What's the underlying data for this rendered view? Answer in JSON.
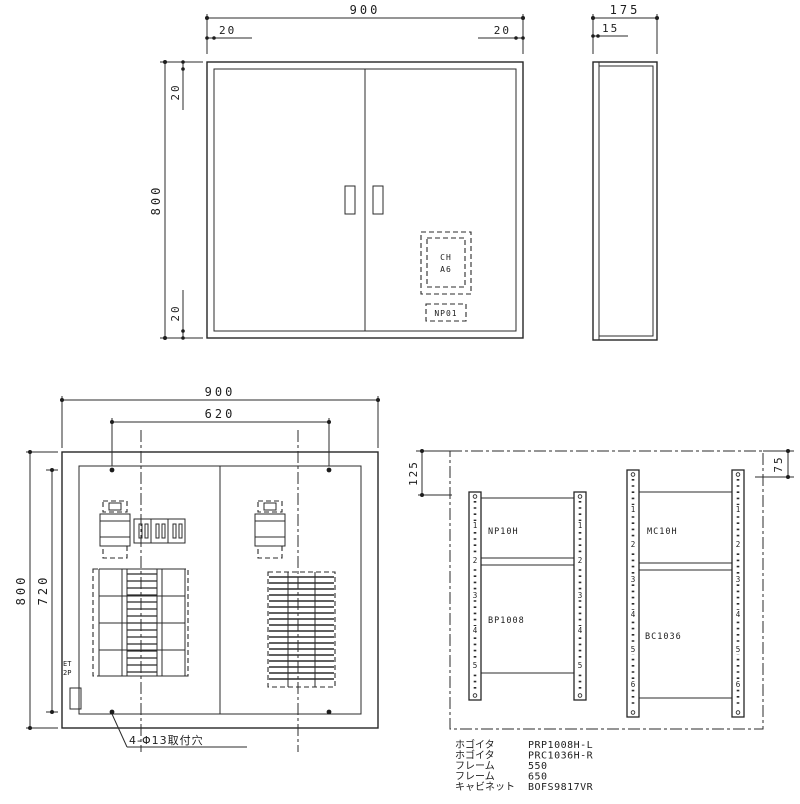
{
  "drawing": {
    "front_view": {
      "dim_width": "900",
      "dim_margin_left": "20",
      "dim_margin_right": "20",
      "dim_height": "800",
      "dim_margin_top": "20",
      "dim_margin_bottom": "20",
      "cutout_line1": "CH",
      "cutout_line2": "A6",
      "nameplate": "NP01"
    },
    "side_view": {
      "dim_depth": "175",
      "dim_door": "15"
    },
    "internal_view": {
      "dim_width": "900",
      "dim_hole_span_w": "620",
      "dim_height": "800",
      "dim_hole_span_h": "720",
      "label_et": "ET",
      "label_2p": "2P",
      "holes_note": "4-Φ13取付穴"
    },
    "frame_view": {
      "dim_left_offset": "125",
      "dim_right_offset": "75",
      "frames": [
        {
          "upper_label": "NP10H",
          "lower_label": "BP1008",
          "numbers": [
            "1",
            "2",
            "3",
            "4",
            "5"
          ]
        },
        {
          "upper_label": "MC10H",
          "lower_label": "BC1036",
          "numbers": [
            "1",
            "2",
            "3",
            "4",
            "5",
            "6"
          ]
        }
      ]
    },
    "parts_list": [
      {
        "label": "ホゴイタ",
        "value": "PRP1008H-L"
      },
      {
        "label": "ホゴイタ",
        "value": "PRC1036H-R"
      },
      {
        "label": "フレーム",
        "value": "550"
      },
      {
        "label": "フレーム",
        "value": "650"
      },
      {
        "label": "キャビネット",
        "value": "BOFS9817VR"
      }
    ],
    "colors": {
      "line": "#2b2b2b",
      "background": "#ffffff",
      "text": "#1d1d1d"
    }
  }
}
